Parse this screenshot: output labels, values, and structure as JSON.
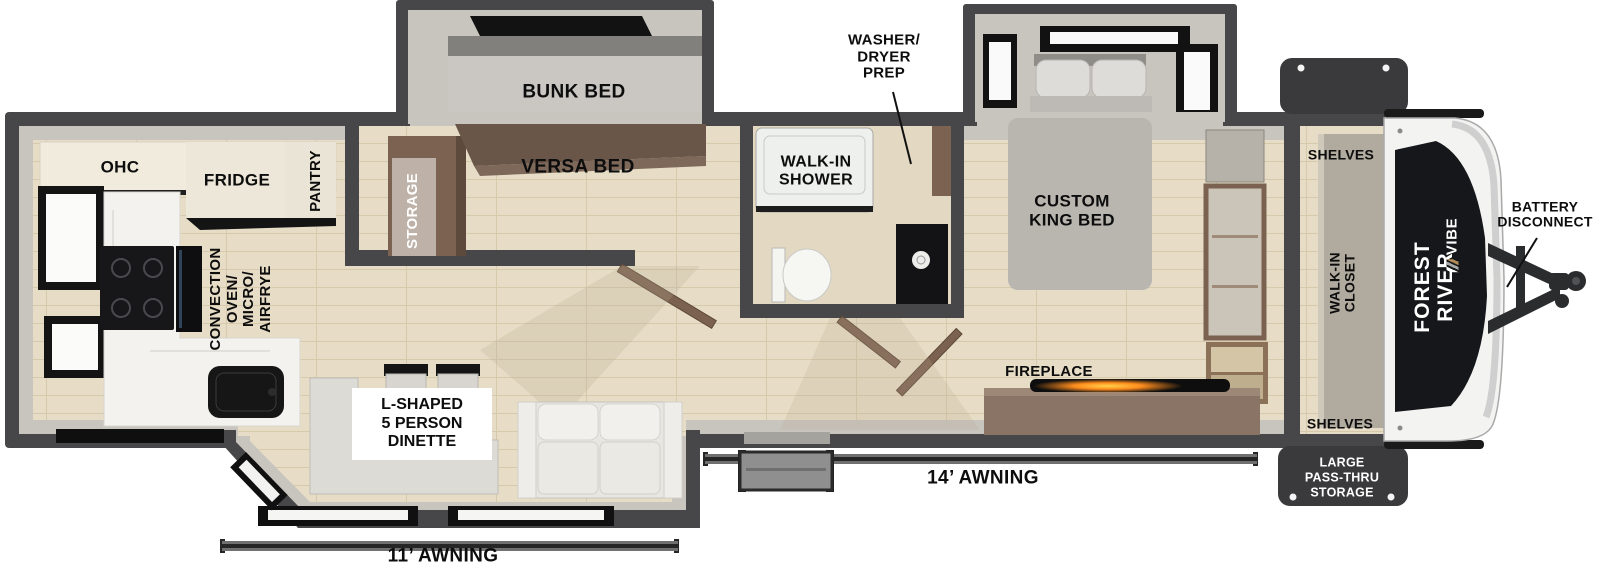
{
  "meta": {
    "type": "rv-floorplan-diagram",
    "brand": {
      "maker": "FOREST RIVER",
      "model": "VIBE"
    }
  },
  "colors": {
    "wall": "#47474a",
    "liner": "#c8c5bf",
    "floor_wood": "#e7ddc6",
    "floor_plank_line": "#d6c9ac",
    "cabinet_cream": "#f0ebdd",
    "cabinet_brown": "#7b6251",
    "versa_brown": "#6a5549",
    "mattress_gray": "#cac7c2",
    "counter_marble": "#f4f2ee",
    "appliance_black": "#141414",
    "dresser_brown": "#8a7466",
    "fire_glow": "#ff8d1e",
    "cap_decal_black": "#16171a",
    "cap_body_white": "#f3f3f2",
    "storage_box_dark": "#3a3a3c",
    "label_text": "#0d0d0d",
    "label_text_inverse": "#ffffff"
  },
  "labels": {
    "kitchen": {
      "ohc": "OHC",
      "fridge": "FRIDGE",
      "pantry": "PANTRY",
      "convection": "CONVECTION\nOVEN/\nMICRO/\nAIRFRYE"
    },
    "bunk_room": {
      "bunk_bed": "BUNK BED",
      "versa_bed": "VERSA BED",
      "storage": "STORAGE"
    },
    "bathroom": {
      "walk_in_shower": "WALK-IN\nSHOWER",
      "washer_dryer_prep": "WASHER/\nDRYER\nPREP"
    },
    "bedroom": {
      "custom_king_bed": "CUSTOM\nKING BED",
      "fireplace": "FIREPLACE"
    },
    "front_closet": {
      "shelves_top": "SHELVES",
      "walk_in_closet": "WALK-IN\nCLOSET",
      "shelves_bottom": "SHELVES"
    },
    "living": {
      "dinette": "L-SHAPED\n5 PERSON\nDINETTE"
    },
    "exterior": {
      "pass_thru_storage": "LARGE\nPASS-THRU\nSTORAGE",
      "battery_disconnect": "BATTERY\nDISCONNECT",
      "awning_14": "14’ AWNING",
      "awning_11": "11’ AWNING"
    },
    "brand": {
      "maker": "FOREST RIVER",
      "model": "VIBE"
    }
  }
}
